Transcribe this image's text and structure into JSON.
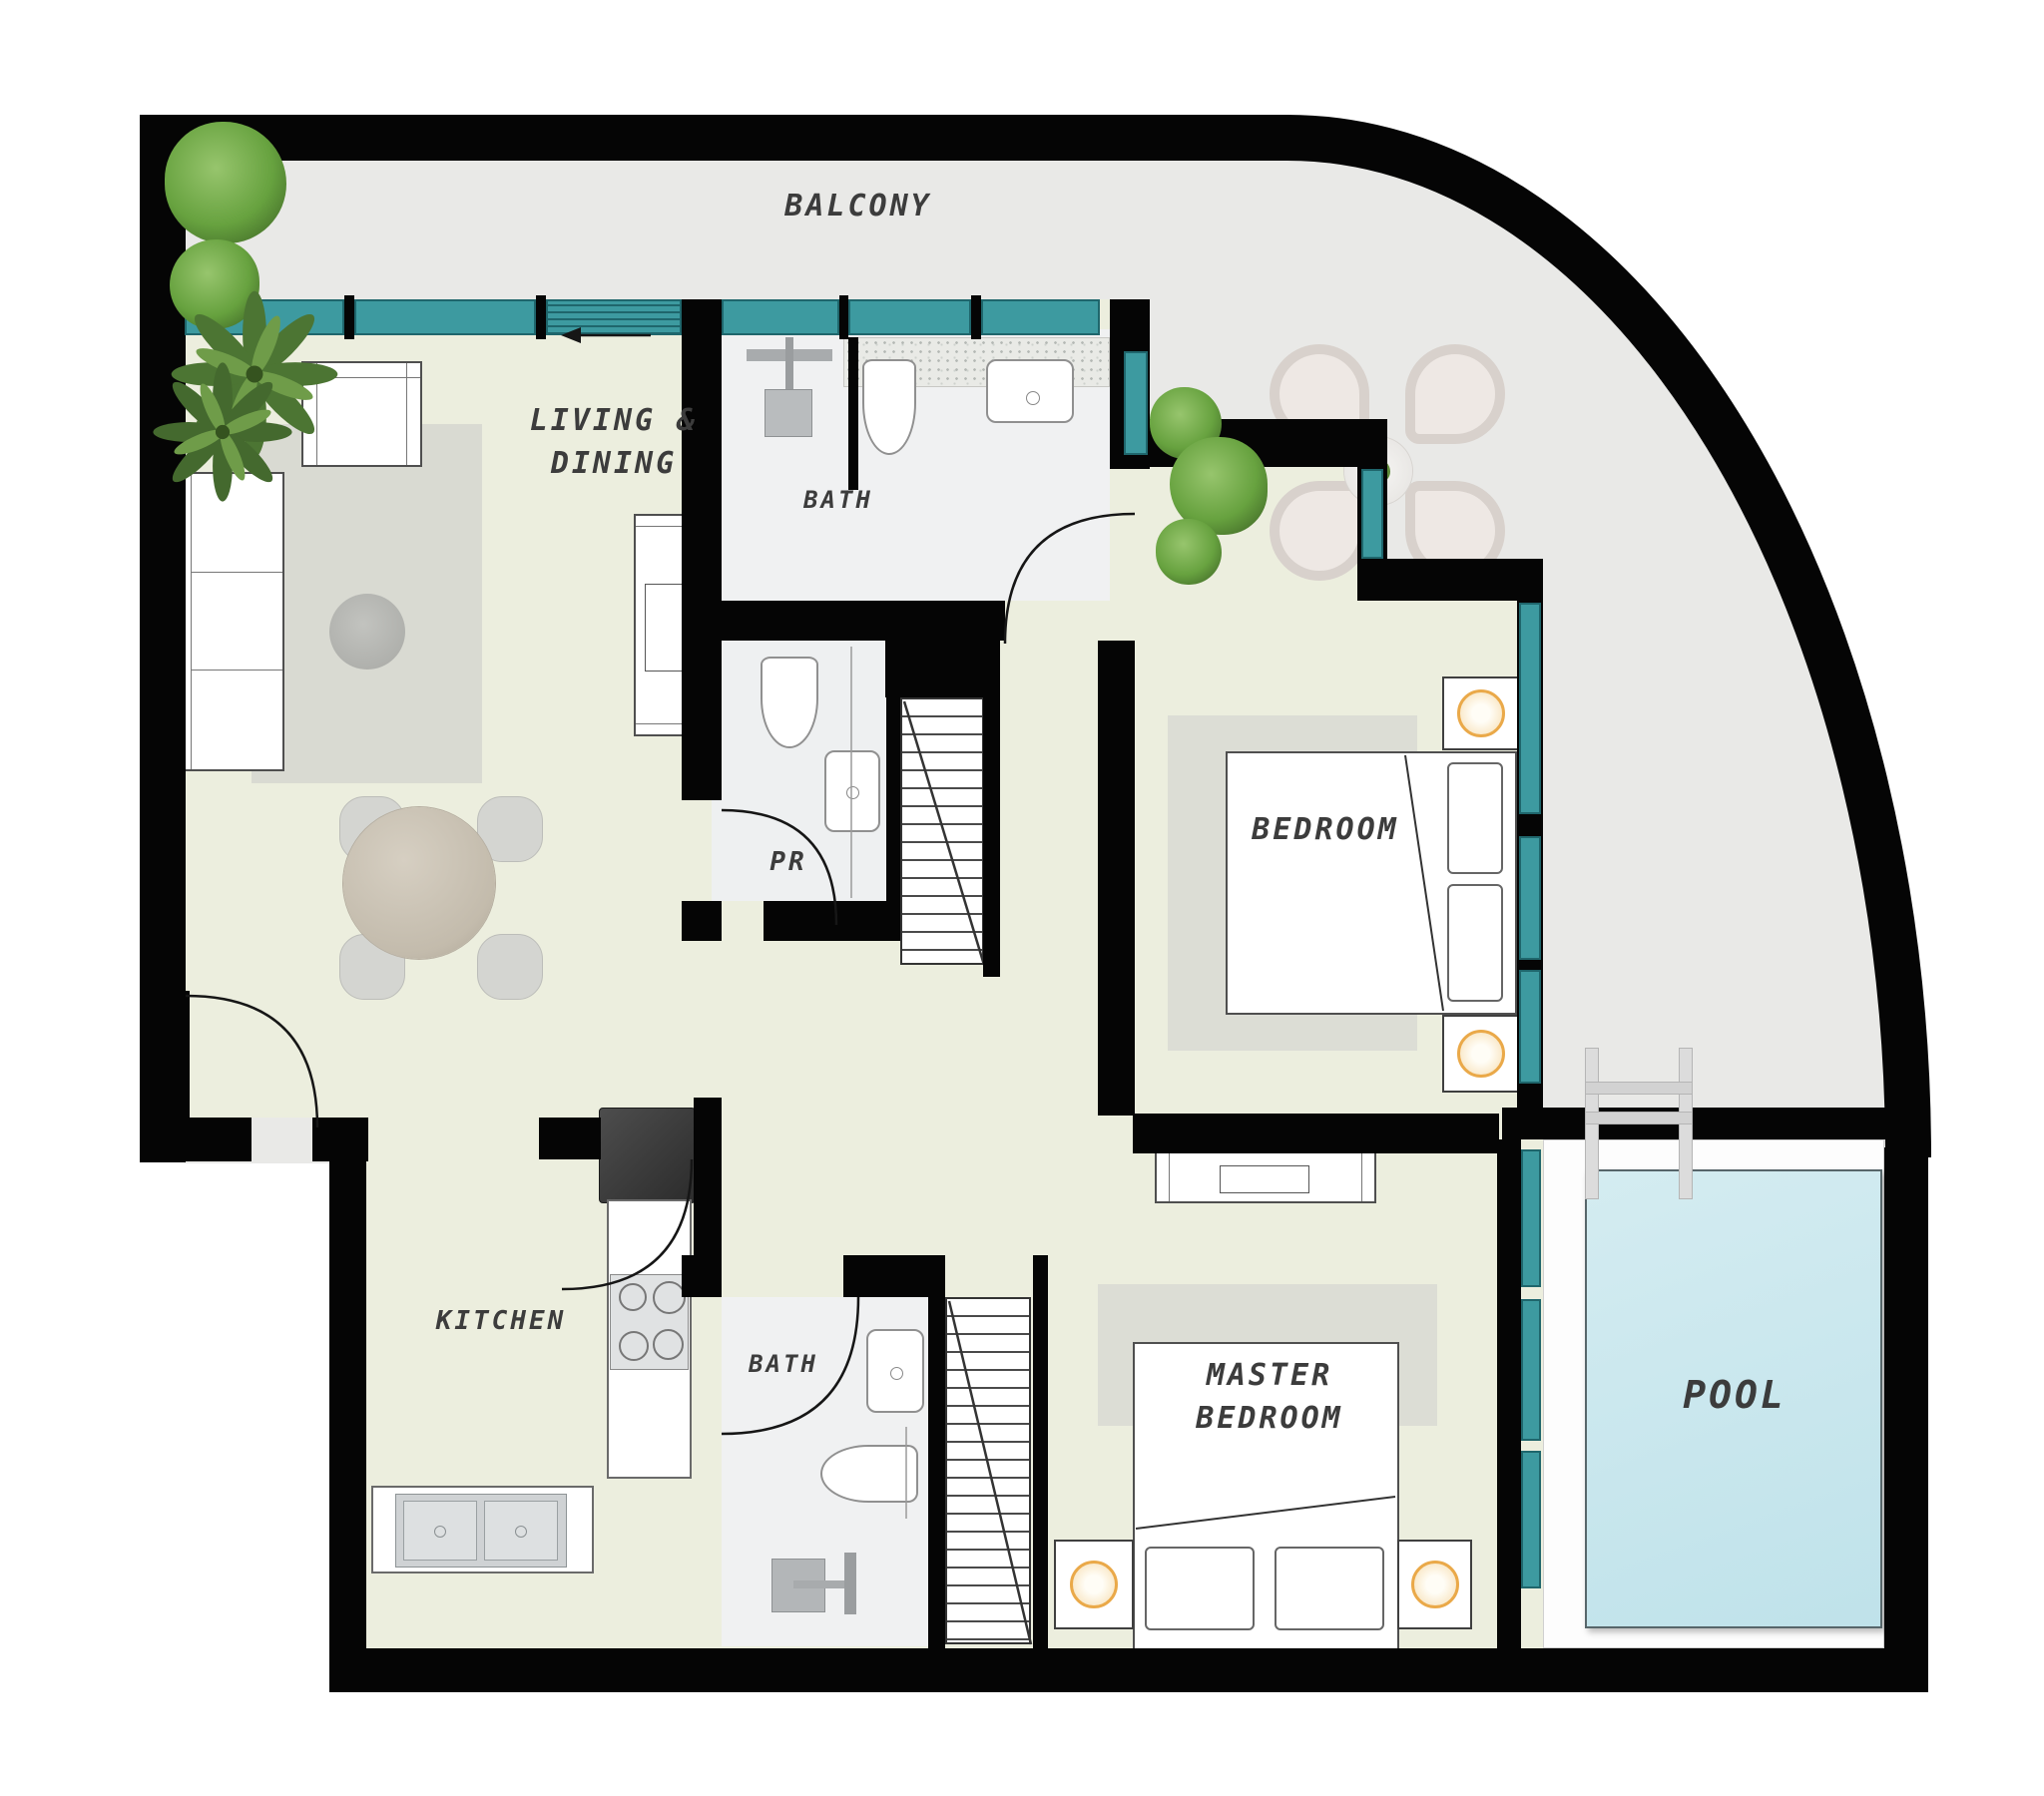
{
  "floorplan": {
    "type": "apartment-floor-plan",
    "labels": {
      "balcony": "BALCONY",
      "living_line1": "LIVING &",
      "living_line2": "DINING",
      "bath_upper": "BATH",
      "powder_room": "PR",
      "bedroom": "BEDROOM",
      "kitchen": "KITCHEN",
      "bath_lower": "BATH",
      "master_line1": "MASTER",
      "master_line2": "BEDROOM",
      "pool": "POOL"
    },
    "colors": {
      "wall": "#050505",
      "interior_floor": "#eceede",
      "balcony_floor": "#e9e9e7",
      "bathroom_floor": "#f0f1f2",
      "window_glass": "#3d9aa0",
      "pool_water": "#cde9ef",
      "pool_deck": "#fdfdfd",
      "rug": "#d9dad2",
      "furniture_outline": "#4f4f4f",
      "lamp_accent": "#eaa949",
      "tree_green": "#67a23f",
      "label_text": "#3c3c3c"
    },
    "icons": {
      "tree-icon": "green gradient circle",
      "palm-tree-icon": "svg rotated leaf star",
      "sofa-icon": "outlined rect with 3 cushions",
      "armchair-icon": "outlined rect with arms",
      "coffee-table-icon": "gray circle",
      "dining-table-icon": "round marble circle",
      "dining-chair-icon": "rounded gray square",
      "tv-console-icon": "outlined rect with inner screen",
      "fridge-icon": "dark square",
      "cooktop-icon": "four burner circles",
      "kitchen-sink-icon": "double bowl steel sink",
      "toilet-icon": "rounded bowl outline",
      "washbasin-icon": "rounded basin with faucet",
      "shower-icon": "gray head square with pipes",
      "bed-icon": "outlined rect with pillows and fold line",
      "nightstand-lamp-icon": "orange ring circle",
      "stairs-icon": "treads with diagonal cut line",
      "door-swing-icon": "quarter arc",
      "window-icon": "teal strip",
      "pool-ladder-icon": "two rails with rungs",
      "outdoor-chair-icon": "petal shaped padded chair",
      "outdoor-table-icon": "small round table with plant"
    }
  }
}
